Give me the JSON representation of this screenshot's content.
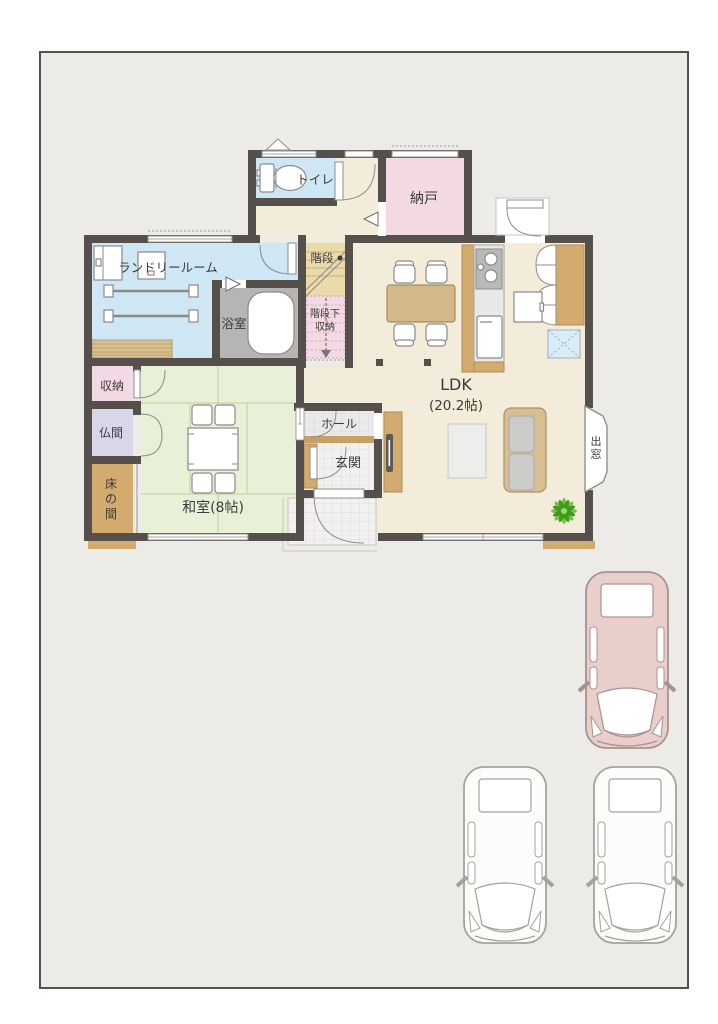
{
  "floor_plan": {
    "rooms": {
      "toilet": "トイレ",
      "nando": "納戸",
      "laundry": "ランドリールーム",
      "stairs": "階段",
      "under_stairs": [
        "階段下",
        "収納"
      ],
      "bath": "浴室",
      "ldk": "LDK",
      "ldk_size": "(20.2帖)",
      "closet": "収納",
      "butsuma": "仏間",
      "tokonoma": [
        "床",
        "の",
        "間"
      ],
      "washitsu": "和室(8帖)",
      "hall": "ホール",
      "genkan": "玄関",
      "bay_window": [
        "出",
        "窓"
      ]
    },
    "colors": {
      "floor_beige": "#f4ecda",
      "water_blue": "#cfe6f4",
      "pink": "#f3d9e4",
      "tatami_green": "#e9f0d8",
      "lavender": "#d9d6ea",
      "wood": "#d4ab6f",
      "stairs_tan": "#ebdaaa",
      "bath_gray": "#b6b5b3",
      "wall": "#55504b",
      "hatch_blue": "#d9ecf8"
    }
  },
  "parking": {
    "cars": [
      {
        "id": "car-pink",
        "body": "#e8cfcb",
        "style": "--car-body:#e8cfcb;--car-line:#a89290"
      },
      {
        "id": "car-white-1",
        "body": "#fcfcfa",
        "style": "--car-body:#fcfcfa;--car-line:#a5a29c"
      },
      {
        "id": "car-white-2",
        "body": "#fcfcfa",
        "style": "--car-body:#fcfcfa;--car-line:#a5a29c"
      }
    ]
  }
}
